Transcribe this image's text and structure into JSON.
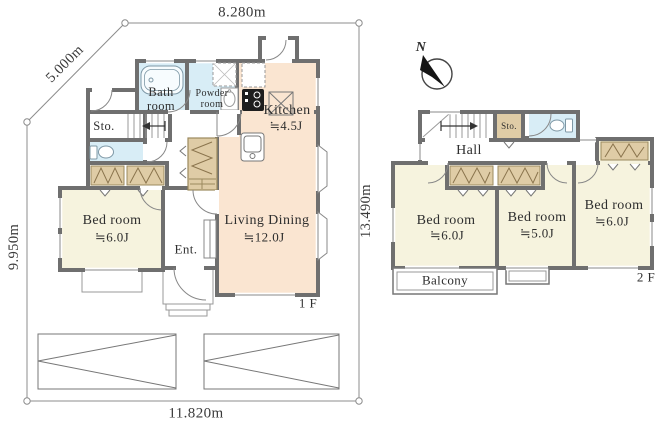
{
  "site": {
    "dim_top": "8.280m",
    "dim_diagonal": "5.000m",
    "dim_left": "9.950m",
    "dim_right": "13.490m",
    "dim_bottom": "11.820m"
  },
  "compass": {
    "north": "N"
  },
  "floor1": {
    "floor_label": "1 F",
    "bath": "Bath room",
    "powder": "Powder room",
    "kitchen_name": "Kitchen",
    "kitchen_size": "≒4.5J",
    "storage": "Sto.",
    "bedroom_name": "Bed room",
    "bedroom_size": "≒6.0J",
    "entrance": "Ent.",
    "living_name": "Living Dining",
    "living_size": "≒12.0J"
  },
  "floor2": {
    "floor_label": "2 F",
    "hall": "Hall",
    "storage": "Sto.",
    "bedroom1_name": "Bed room",
    "bedroom1_size": "≒6.0J",
    "bedroom2_name": "Bed room",
    "bedroom2_size": "≒5.0J",
    "bedroom3_name": "Bed room",
    "bedroom3_size": "≒6.0J",
    "balcony": "Balcony"
  },
  "colors": {
    "wall": "#6f6f6f",
    "room_warm": "#fae5d1",
    "room_cream": "#f6f3de",
    "room_wet": "#d8edf6",
    "closet": "#dfcca6"
  }
}
